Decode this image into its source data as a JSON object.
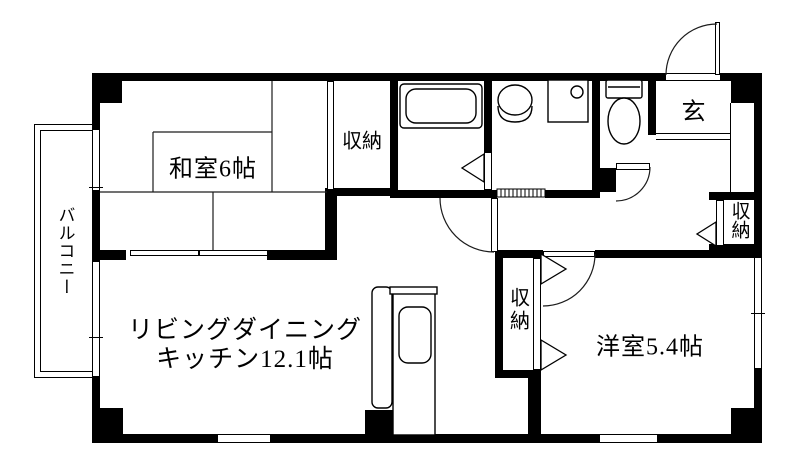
{
  "plan_title": "apartment-floor-plan",
  "rooms": {
    "washitsu": {
      "label": "和室6帖"
    },
    "ldk": {
      "label_line1": "リビングダイニング",
      "label_line2": "キッチン12.1帖"
    },
    "yoshitsu": {
      "label": "洋室5.4帖"
    },
    "genkan": {
      "label": "玄"
    },
    "balcony": {
      "label": "バルコニー"
    },
    "closet_top": {
      "label": "収納"
    },
    "closet_hall": {
      "label": "収納"
    },
    "closet_mid": {
      "label": "収納"
    }
  },
  "icons": {
    "bathtub": "bathtub-icon",
    "washbasin": "washbasin-icon",
    "washer_pan": "washer-pan-icon",
    "toilet": "toilet-icon",
    "kitchen_counter": "kitchen-counter-icon",
    "door_swing": "door-swing-arc",
    "folding_door": "folding-door-triangle"
  },
  "colors": {
    "wall": "#000000",
    "background": "#ffffff",
    "line": "#1c1c1c"
  }
}
